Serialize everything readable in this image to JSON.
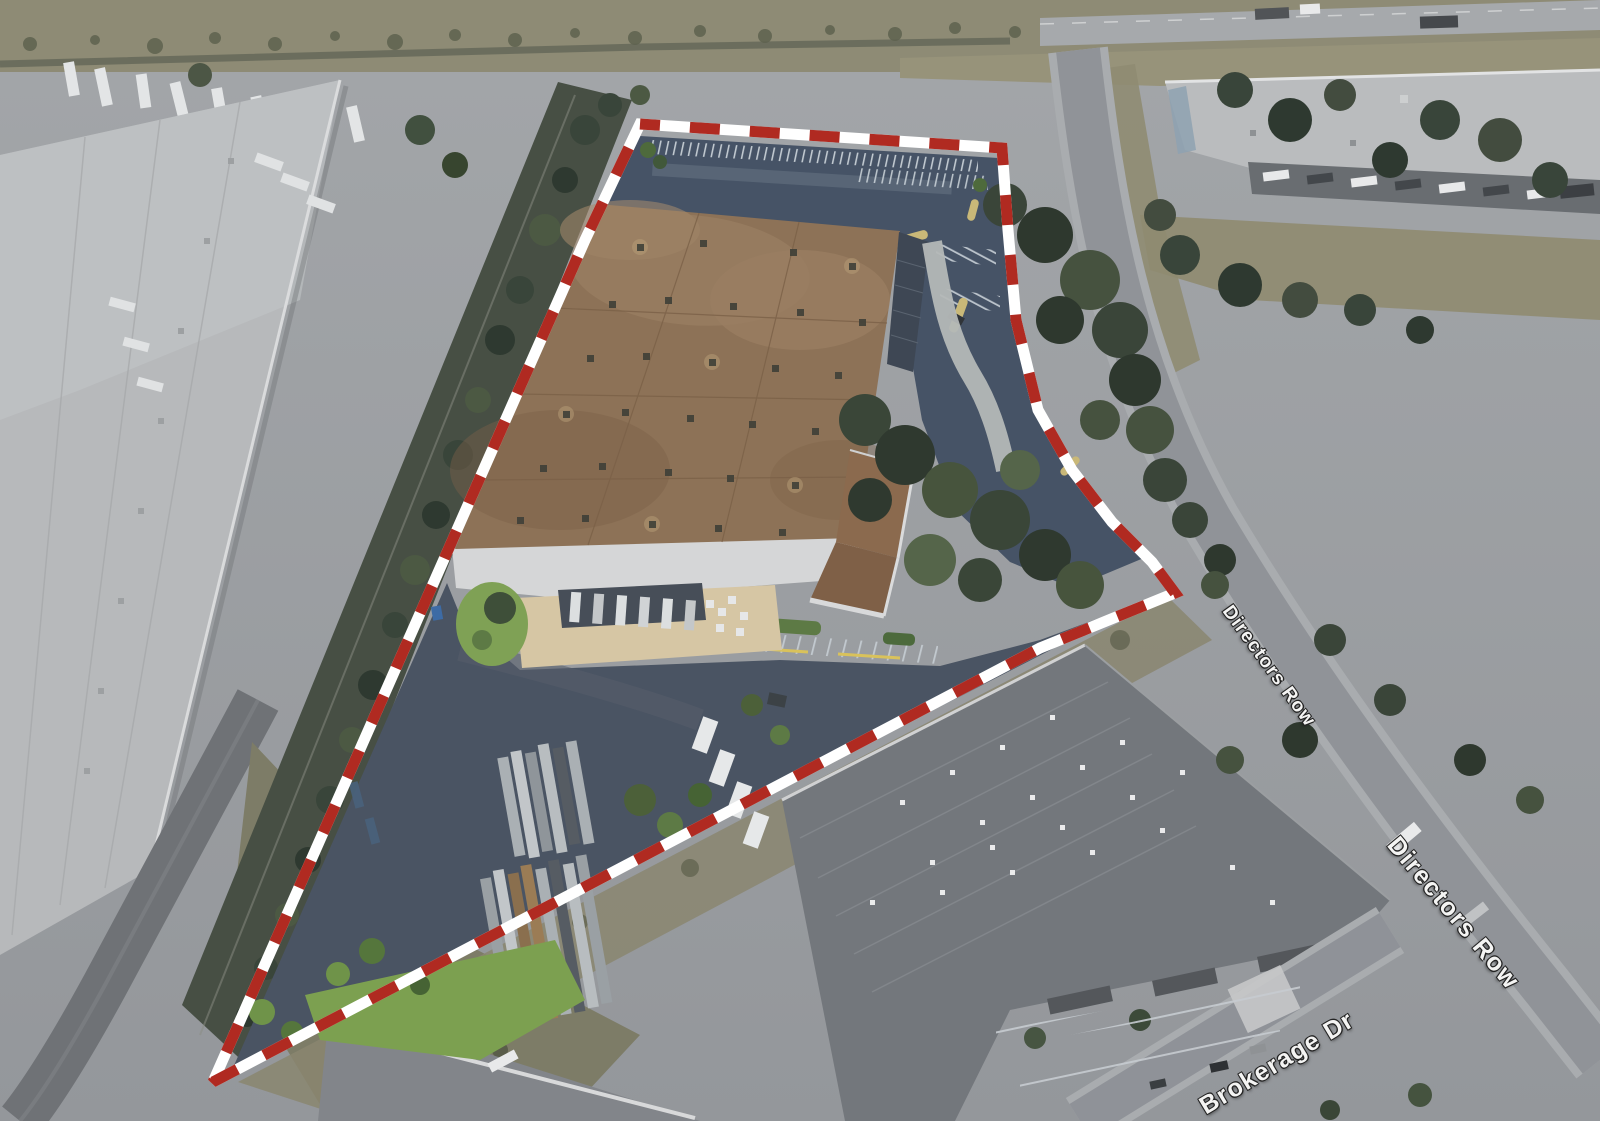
{
  "scene": {
    "title": "Aerial property view",
    "type": "oblique-aerial-satellite-photo",
    "subject": "Industrial warehouse parcel outlined with a red-and-white dashed property boundary",
    "street_labels": [
      {
        "id": "directors-row-upper",
        "text": "Directors Row"
      },
      {
        "id": "directors-row-lower",
        "text": "Directors Row"
      },
      {
        "id": "brokerage-dr",
        "text": "Brokerage Dr"
      }
    ],
    "boundary": {
      "style": "alternating dashed",
      "dash_color": "#b02a21",
      "gap_color": "#ffffff",
      "stroke_width_px": 11,
      "dash_length_px": 30
    },
    "colors": {
      "subject_roof_brown": "#8d7257",
      "subject_walls_white": "#d8d9da",
      "asphalt_dark": "#475366",
      "context_pavement": "#9b9ea2",
      "context_roof_light": "#b7b9bb",
      "context_roof_dark": "#73777c",
      "vegetation_dark": "#3a4638",
      "lawn_green": "#7fa155",
      "concrete_apron_tan": "#d6c6a4",
      "road_gray": "#a9acaf"
    },
    "label_style": {
      "text_color": "#f4f4f3",
      "outline_color": "#242424"
    }
  }
}
